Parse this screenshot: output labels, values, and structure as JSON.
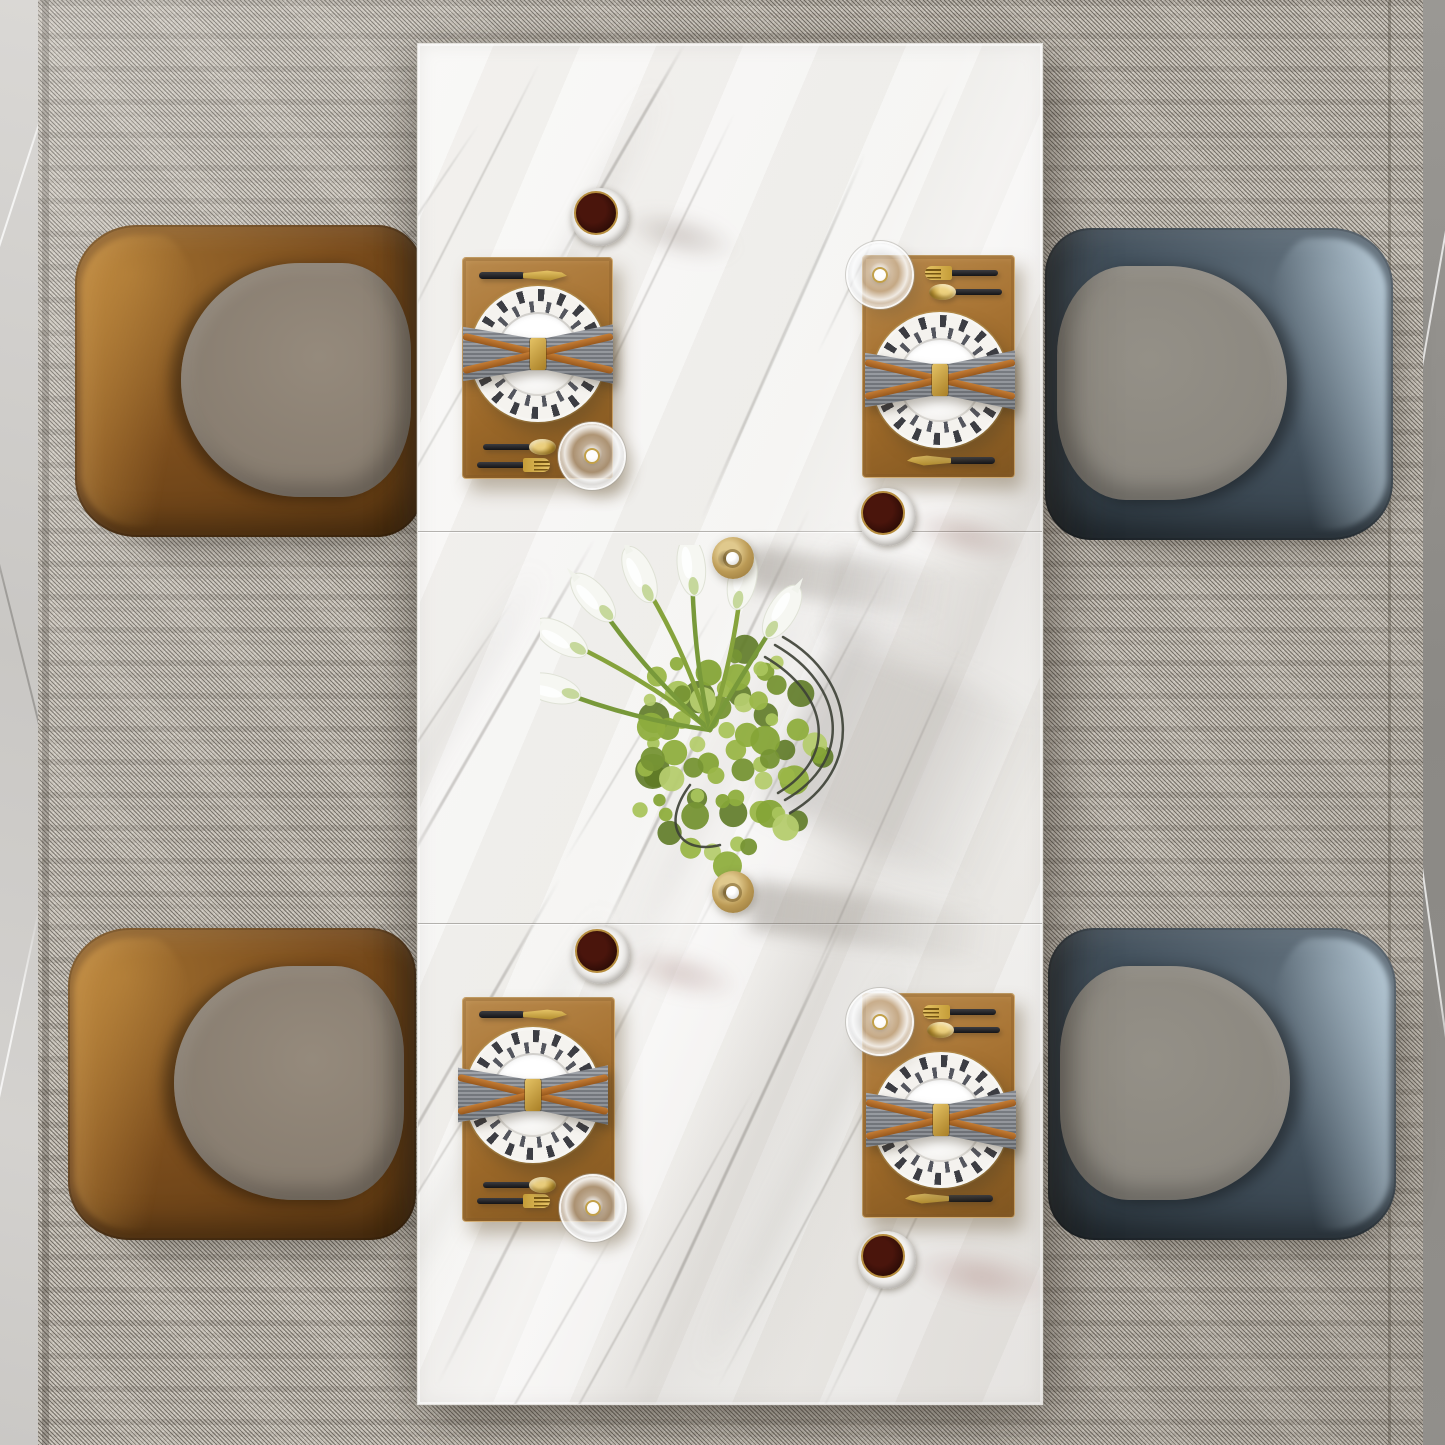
{
  "scene": {
    "type": "interior product photograph",
    "view": "top-down",
    "subject": "Modern rectangular white marble dining table set for four",
    "environment": "woven gray area rug over marble floor",
    "lighting": "soft daylight from upper-left casting long soft shadows to the right"
  },
  "palette": {
    "tabletop_marble": "#f3f2ef",
    "marble_vein": "#96938f",
    "rug_weave": "#c7c1b7",
    "floor_left_marble": "#d1cfcc",
    "floor_right_marble": "#8f8d8a",
    "placemat_tan": "#a87434",
    "napkin_gray": "#8d9196",
    "napkin_strap_leather": "#b4712e",
    "gold_accent": "#c9a23c",
    "cutlery_handle_black": "#26262a",
    "chair_leather_brown": "#7a4c1c",
    "chair_leather_blue_gray": "#43515d",
    "chair_blue_gloss": "#aec3d2",
    "chair_seat_fabric": "#8b8175",
    "dark_drink": "#2a0e08",
    "foliage_green": "#8fae3e",
    "lily_white": "#f6f7f2"
  },
  "counts": {
    "chairs": 4,
    "place_settings": 4,
    "cups_of_dark_drink": 4,
    "tumbler_glasses": 4,
    "calla_lilies": 7,
    "candle_holders": 2,
    "tabletop_panels": 3,
    "panel_seams": 2
  },
  "labels": {
    "stage": "Top-down dining set scene",
    "table": "Rectangular white marble dining table with two panel seams",
    "rug": "Woven gray-beige area rug with fine diagonal weave",
    "floor_left": "Light gray marble floor strip",
    "floor_right": "Dark gray marble floor strip",
    "chair_tl": "Brown leather armchair, top left, facing table",
    "chair_tr": "Blue-gray leather armchair, top right, facing table",
    "chair_bl": "Brown leather armchair, bottom left, facing table",
    "chair_br": "Blue-gray leather armchair, bottom right, facing table",
    "setting": "Place setting: tan placemat, geometric-rim plate, gray bow napkin, gold cutlery, tumbler glass",
    "placemat": "Tan linen placemat",
    "plate": "White dinner plate with black geometric triangle rim and gold edge",
    "napkin": "Gray napkin folded as a bow with tan leather straps and gold buckle",
    "knife": "Gold knife with black handle",
    "fork": "Gold fork with black handle",
    "spoon": "Gold spoon with black handle",
    "glass": "Clear glass tumbler",
    "cup": "Cup filled with dark coffee",
    "candle": "Brass candle holder with pearl center",
    "centerpiece": "White calla lilies and green hydrangea in a dark wire vase",
    "seam": "Tabletop panel seam"
  },
  "chairs": [
    {
      "position": "top-left",
      "frame": "glossy brown leather",
      "seat": "taupe gray fabric",
      "facing": "right"
    },
    {
      "position": "top-right",
      "frame": "glossy blue-gray leather with frosted light-blue highlight",
      "seat": "gray fabric",
      "facing": "left"
    },
    {
      "position": "bottom-left",
      "frame": "glossy brown leather",
      "seat": "taupe gray fabric",
      "facing": "right"
    },
    {
      "position": "bottom-right",
      "frame": "glossy blue-gray leather with frosted light-blue highlight",
      "seat": "gray fabric",
      "facing": "left"
    }
  ],
  "place_settings": [
    {
      "position": "top-left",
      "layout": "knife above plate, spoon and fork below, glass at lower-right corner",
      "cup_location": "above placemat"
    },
    {
      "position": "top-right",
      "layout": "fork and spoon above plate, knife below, glass at upper-left corner",
      "cup_location": "below placemat"
    },
    {
      "position": "bottom-left",
      "layout": "knife above plate, spoon and fork below, glass at lower-right corner",
      "cup_location": "above placemat"
    },
    {
      "position": "bottom-right",
      "layout": "fork and spoon above plate, knife below, glass at upper-left corner",
      "cup_location": "below placemat"
    }
  ],
  "centerpiece": {
    "flowers": "white calla lilies fanned toward upper-left",
    "flower_count": 7,
    "foliage": "green hydrangea cluster",
    "vase": "dark curved wire-frame vase",
    "flanked_by": [
      "brass candle holder above",
      "brass candle holder below"
    ]
  }
}
